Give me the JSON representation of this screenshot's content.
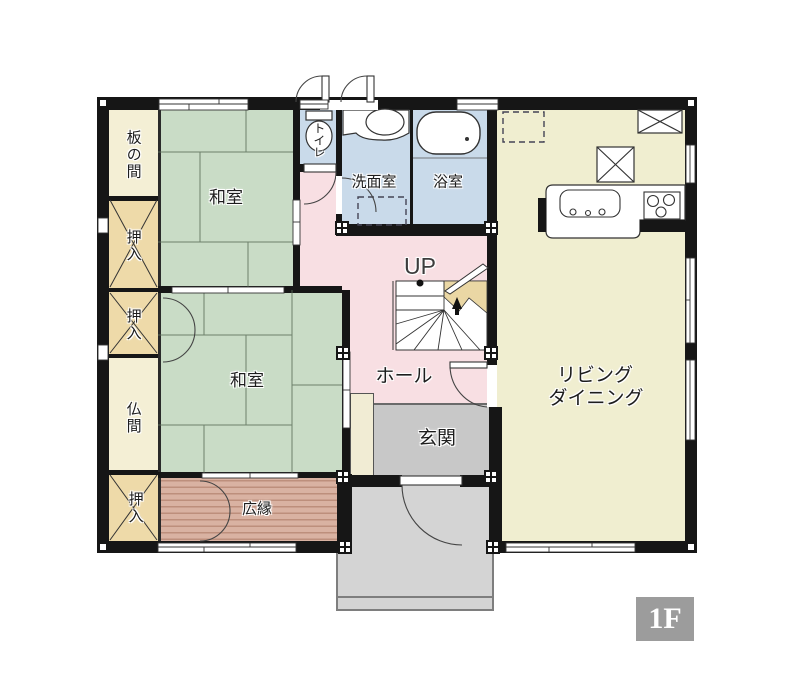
{
  "floor_badge": "1F",
  "stairs": {
    "direction_label": "UP"
  },
  "rooms": {
    "itanoma": "板の間",
    "washitsu_north": "和室",
    "washitsu_south": "和室",
    "oshiire_1": "押入",
    "oshiire_2": "押入",
    "oshiire_3": "押入",
    "butsuma": "仏間",
    "toilet": "トイレ",
    "senmenshitsu": "洗面室",
    "yokushitsu": "浴室",
    "hall": "ホール",
    "genkan": "玄関",
    "hiroen": "広縁",
    "living_dining_line1": "リビング",
    "living_dining_line2": "ダイニング"
  },
  "colors": {
    "wall": "#161616",
    "tatami": "#c9dcc6",
    "cream_room": "#f4efd5",
    "closet": "#eedaa9",
    "wet_area": "#c9daea",
    "hall": "#f8dfe3",
    "living_dining": "#f0eed0",
    "engawa_base": "#d9b2a2",
    "engawa_stripe": "#bd8f7c",
    "entry_floor": "#c8c8c8",
    "porch": "#d4d4d4",
    "stair_landing_accent": "#ead7a4",
    "badge_background": "#9c9c9c",
    "badge_text": "#ffffff"
  }
}
